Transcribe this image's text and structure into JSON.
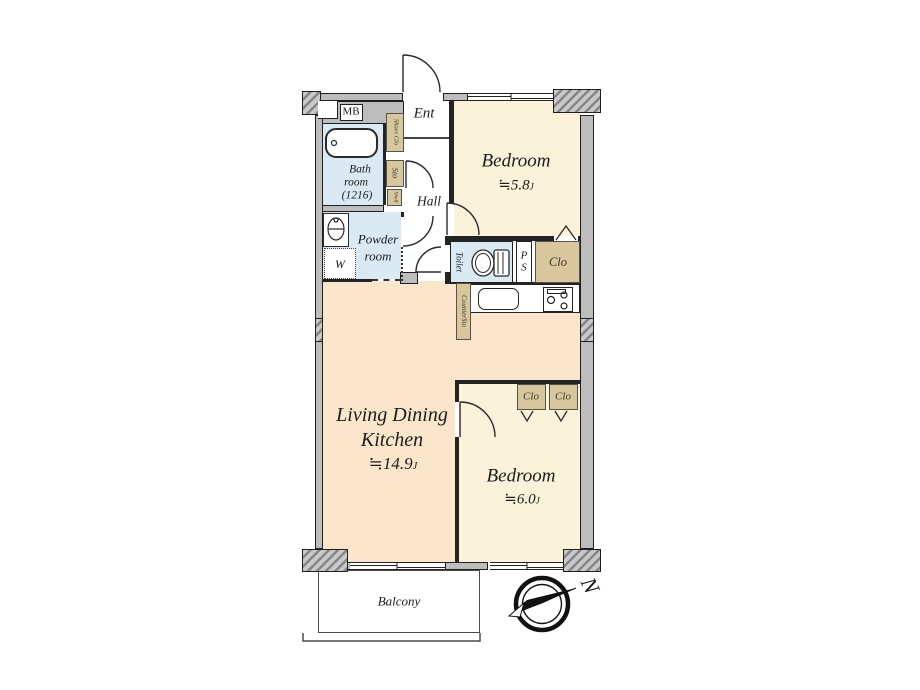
{
  "rooms": {
    "bedroom1": {
      "name": "Bedroom",
      "size": "≒5.8",
      "unit": "J"
    },
    "bedroom2": {
      "name": "Bedroom",
      "size": "≒6.0",
      "unit": "J"
    },
    "ldk": {
      "line1": "Living Dining",
      "line2": "Kitchen",
      "size": "≒14.9",
      "unit": "J"
    },
    "bath": {
      "line1": "Bath",
      "line2": "room",
      "line3": "(1216)"
    },
    "powder": {
      "line1": "Powder",
      "line2": "room"
    },
    "ent": "Ent",
    "hall": "Hall",
    "toilet": "Toilet",
    "balcony": "Balcony",
    "mb": "MB",
    "ps": {
      "line1": "P",
      "line2": "S"
    },
    "washer": "W",
    "shoes_clo": "Shoes Clo",
    "sto": "Sto",
    "shelf": "Shelf",
    "counter_sto": "CounterSto",
    "clo_hall": "Clo",
    "clo_bedroom2_left": "Clo",
    "clo_bedroom2_right": "Clo"
  },
  "compass": {
    "north": "N"
  },
  "colors": {
    "room_cream": "#faf3da",
    "room_peach": "#fbe6cb",
    "room_blue": "#d9eaf4",
    "closet_tan": "#d8c79c",
    "wall_gray": "#bdbdbd"
  }
}
